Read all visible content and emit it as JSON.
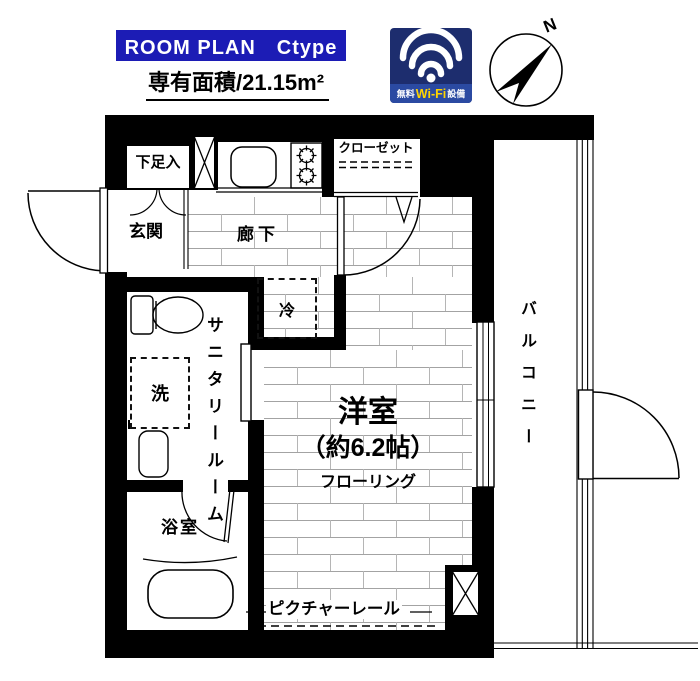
{
  "header": {
    "banner": "ROOM PLAN　Ctype",
    "area": "専有面積/21.15m²",
    "wifi": {
      "prefix": "無料",
      "brand": "Wi-Fi",
      "suffix": "設備"
    },
    "compass_n": "N"
  },
  "plan": {
    "rooms": {
      "entrance": "玄関",
      "shoe_box": "下足入",
      "hallway": "廊下",
      "closet": "クローゼット",
      "fridge": "冷",
      "sanitary": "サニタリールーム",
      "laundry": "洗",
      "bathroom": "浴室",
      "main_room": "洋室",
      "main_room_size": "（約6.2帖）",
      "main_room_floor": "フローリング",
      "picture_rail": "ピクチャーレール",
      "balcony": "バルコニー"
    }
  },
  "colors": {
    "banner_blue": "#1c1cb5",
    "wifi_bg": "#1d2d6e",
    "wifi_band": "#2b4aa2",
    "wifi_yellow": "#ffd400",
    "wall": "#000000"
  }
}
